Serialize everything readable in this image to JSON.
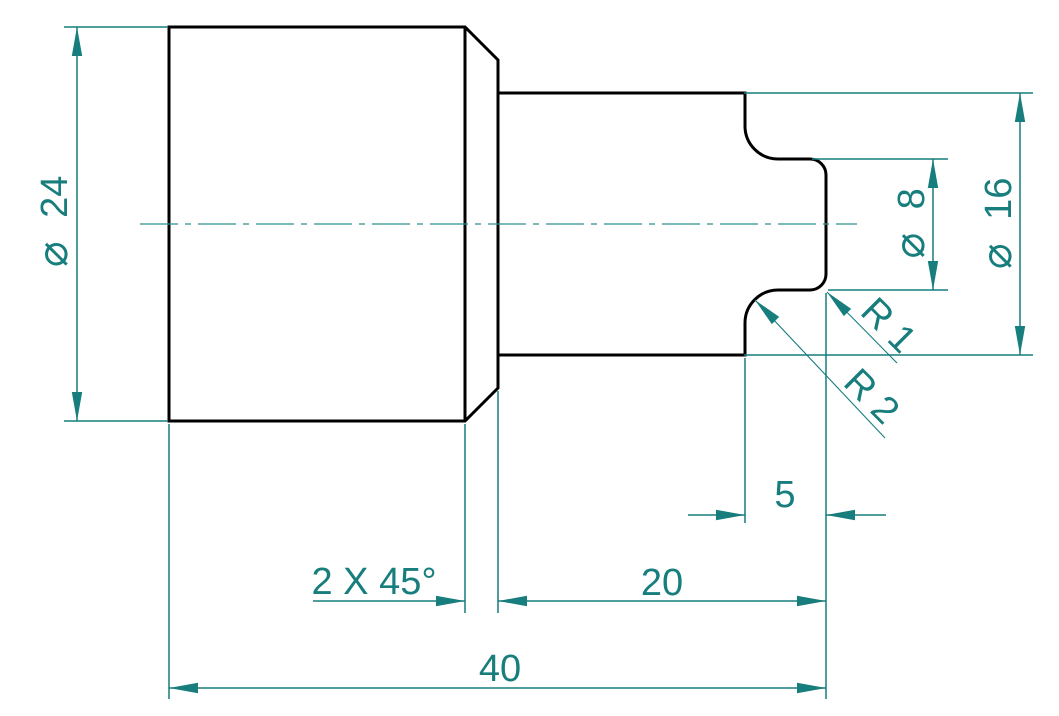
{
  "drawing": {
    "view": "side view of a turned stepped shaft",
    "background_color": "#ffffff",
    "outline_color": "#000000",
    "dimension_color": "#177d7d",
    "dimensions": {
      "dia_large": {
        "symbol": "⌀",
        "value": "24"
      },
      "dia_mid": {
        "symbol": "⌀",
        "value": "16"
      },
      "dia_small": {
        "symbol": "⌀",
        "value": "8"
      },
      "length_total": {
        "label": "40"
      },
      "length_mid": {
        "label": "20"
      },
      "length_stub": {
        "label": "5"
      },
      "chamfer": {
        "label": "2 X 45°"
      },
      "radius_end": {
        "label": "R 1"
      },
      "radius_base": {
        "label": "R 2"
      }
    }
  }
}
